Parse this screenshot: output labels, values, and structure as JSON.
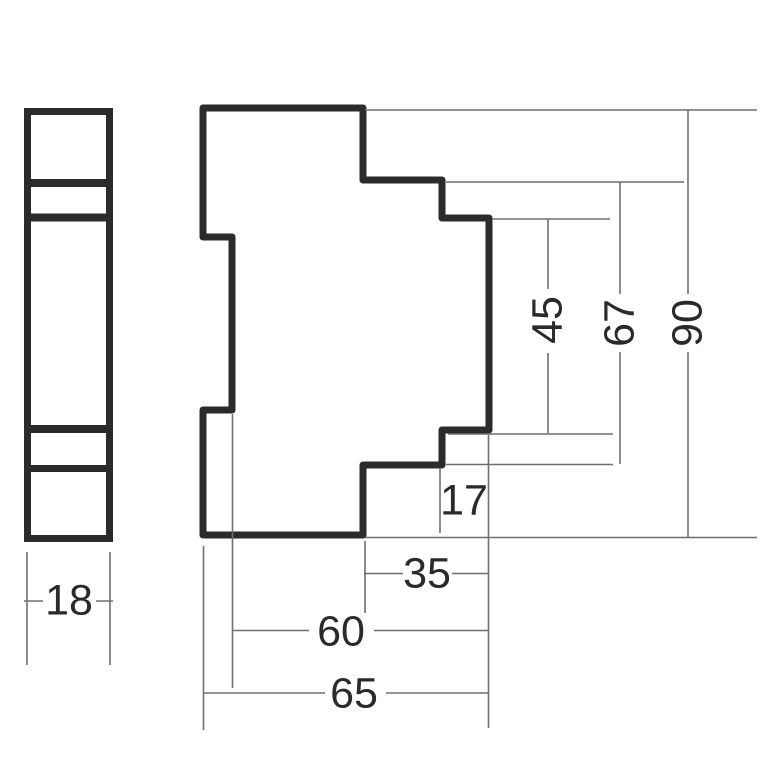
{
  "drawing": {
    "type": "technical-dimension-drawing",
    "views": {
      "front_view": {
        "description": "narrow front face of module",
        "width_mm": "18"
      },
      "side_view": {
        "description": "stepped side profile of module",
        "total_height_mm": "90",
        "mid_height_mm": "67",
        "lower_height_mm": "45",
        "step_depth_mm": "17",
        "upper_depth_mm": "35",
        "mid_depth_mm": "60",
        "total_depth_mm": "65"
      }
    },
    "colors": {
      "background": "#ffffff",
      "outline": "#2b2b2b",
      "thin_line": "#6f6f6f",
      "text": "#2a2a2a"
    }
  }
}
